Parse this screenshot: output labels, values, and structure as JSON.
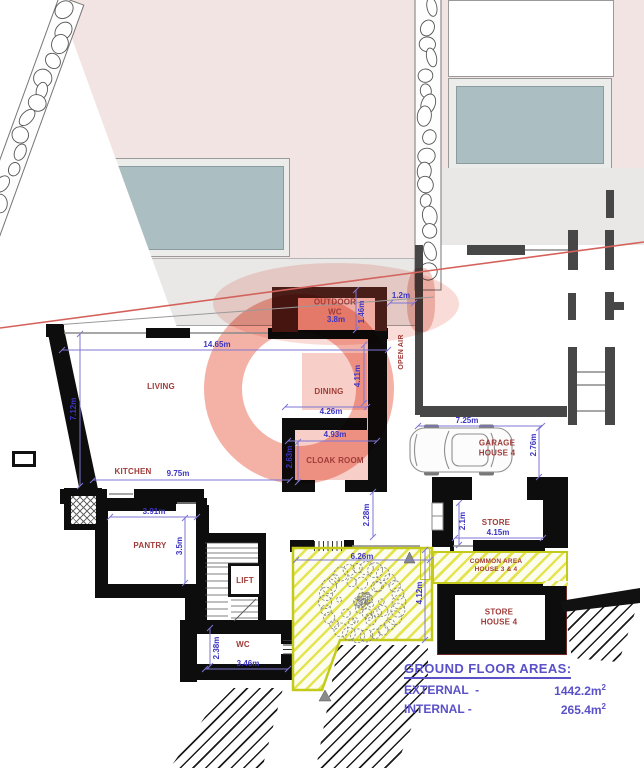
{
  "title": "Ground Floor Plan",
  "plan": {
    "room_labels": [
      {
        "text": "LIVING",
        "x": 161,
        "y": 387
      },
      {
        "text": "KITCHEN",
        "x": 133,
        "y": 472
      },
      {
        "text": "OUTDOOR\nWC",
        "x": 335,
        "y": 307
      },
      {
        "text": "DINING",
        "x": 329,
        "y": 392
      },
      {
        "text": "CLOAK ROOM",
        "x": 335,
        "y": 461
      },
      {
        "text": "GARAGE\nHOUSE 4",
        "x": 497,
        "y": 448
      },
      {
        "text": "STORE",
        "x": 496,
        "y": 523
      },
      {
        "text": "COMMON AREA\nHOUSE 3 & 4",
        "x": 496,
        "y": 566,
        "size": 6.5
      },
      {
        "text": "STORE\nHOUSE 4",
        "x": 499,
        "y": 617
      },
      {
        "text": "PANTRY",
        "x": 150,
        "y": 546
      },
      {
        "text": "LIFT",
        "x": 245,
        "y": 581
      },
      {
        "text": "WC",
        "x": 243,
        "y": 645
      },
      {
        "text": "OPEN AIR",
        "x": 402,
        "y": 352,
        "rot": -90,
        "size": 7
      }
    ],
    "dimensions": [
      {
        "text": "14.65m",
        "x": 217,
        "y": 345
      },
      {
        "text": "7.12m",
        "x": 74,
        "y": 409,
        "rot": -90
      },
      {
        "text": "9.75m",
        "x": 178,
        "y": 474
      },
      {
        "text": "3.8m",
        "x": 336,
        "y": 320
      },
      {
        "text": "1.46m",
        "x": 362,
        "y": 312,
        "rot": -90
      },
      {
        "text": "1.2m",
        "x": 401,
        "y": 296
      },
      {
        "text": "4.26m",
        "x": 331,
        "y": 412
      },
      {
        "text": "4.11m",
        "x": 358,
        "y": 376,
        "rot": -90
      },
      {
        "text": "4.93m",
        "x": 335,
        "y": 435
      },
      {
        "text": "2.63m",
        "x": 290,
        "y": 457,
        "rot": -90
      },
      {
        "text": "2.28m",
        "x": 367,
        "y": 515,
        "rot": -90
      },
      {
        "text": "7.25m",
        "x": 467,
        "y": 421
      },
      {
        "text": "2.76m",
        "x": 534,
        "y": 445,
        "rot": -90
      },
      {
        "text": "2.1m",
        "x": 463,
        "y": 521,
        "rot": -90
      },
      {
        "text": "4.15m",
        "x": 498,
        "y": 533
      },
      {
        "text": "3.91m",
        "x": 154,
        "y": 512
      },
      {
        "text": "3.5m",
        "x": 180,
        "y": 546,
        "rot": -90
      },
      {
        "text": "6.26m",
        "x": 362,
        "y": 557
      },
      {
        "text": "4.12m",
        "x": 420,
        "y": 593,
        "rot": -90
      },
      {
        "text": "2.38m",
        "x": 217,
        "y": 648,
        "rot": -90
      },
      {
        "text": "3.46m",
        "x": 248,
        "y": 664
      }
    ]
  },
  "areas": {
    "title": "GROUND FLOOR  AREAS:",
    "rows": [
      {
        "label": "EXTERNAL  -",
        "value": "1442.2m",
        "sup": "2"
      },
      {
        "label": "INTERNAL -",
        "value": "265.4m",
        "sup": "2"
      }
    ]
  },
  "colors": {
    "dimension_text": "#3d35c2",
    "room_label_text": "#a03c38",
    "areas_text": "#5a50c8",
    "watermark_pink": "#f2a398",
    "hatch_yellow": "#c3ca1c",
    "red_site_line": "#d4625c",
    "building_fill": "#f2e4e2",
    "pool_fill": "#abbec1",
    "terrace_fill": "#e9e8e7"
  }
}
